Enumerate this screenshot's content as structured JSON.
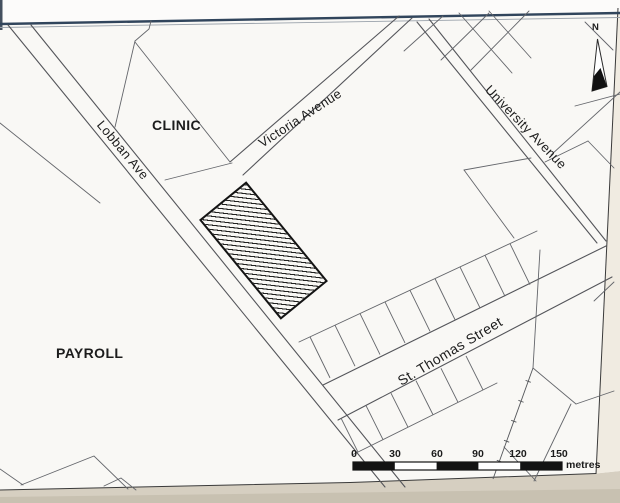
{
  "map": {
    "area_labels": {
      "clinic": "CLINIC",
      "payroll": "PAYROLL"
    },
    "street_labels": {
      "lobban": "Lobban Ave",
      "victoria": "Victoria Avenue",
      "university": "University Avenue",
      "st_thomas": "St. Thomas Street"
    },
    "north_indicator": {
      "label": "N"
    },
    "scale_bar": {
      "ticks": [
        "0",
        "30",
        "60",
        "90",
        "120",
        "150"
      ],
      "unit": "metres"
    },
    "colors": {
      "border_navy": "#31455c",
      "map_line": "#54555a",
      "parcel_line": "#64666b",
      "building_outline": "#141414",
      "scale_black": "#131313",
      "paper": "#f9f8f5",
      "photo_edge_bottom": "#d6cfc1",
      "photo_edge_right": "#f0ebe1"
    }
  }
}
